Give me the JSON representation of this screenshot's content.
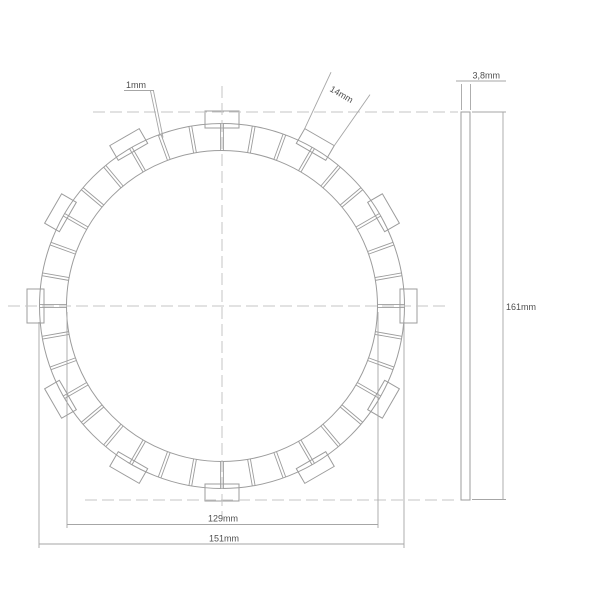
{
  "drawing": {
    "description": "Technical drawing of a motorcycle clutch friction plate, front view with toothed friction pads and side thickness view",
    "labels": {
      "groove_width": "1mm",
      "tab_width": "14mm",
      "thickness": "3,8mm",
      "overall_height": "161mm",
      "inner_pad_diameter": "129mm",
      "outer_diameter": "151mm"
    },
    "part": {
      "tab_count": 12,
      "tab_step_deg": 30,
      "pad_count": 36,
      "pad_step_deg": 10
    },
    "colors": {
      "geometry_line": "#9c9c9c",
      "dimension_line": "#a6a6a6",
      "centerline": "#c6c6c6",
      "text": "#4f4f4f",
      "background": "#ffffff"
    }
  }
}
